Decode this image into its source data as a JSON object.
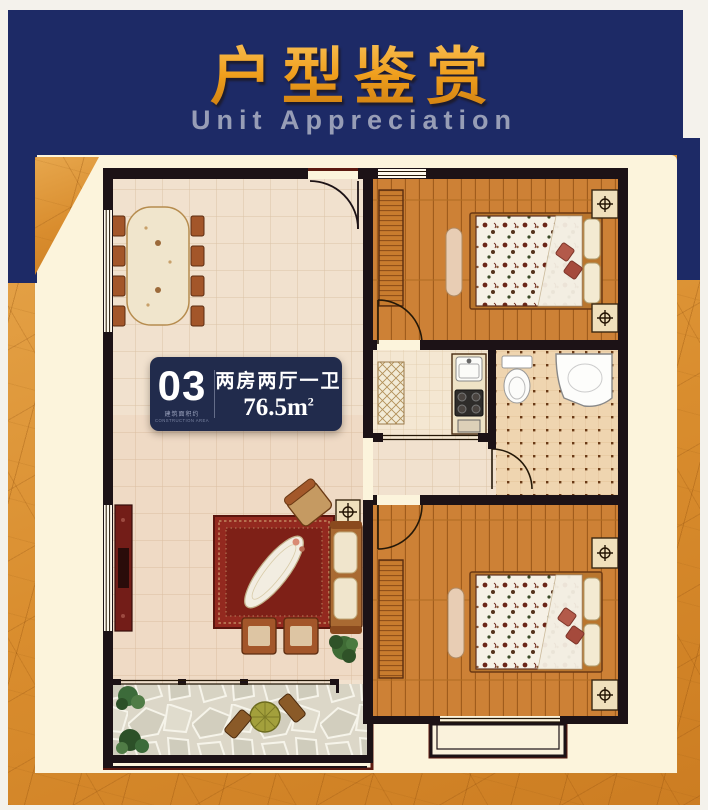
{
  "header": {
    "title": "户型鉴赏",
    "subtitle": "Unit Appreciation"
  },
  "badge": {
    "unit_number": "03",
    "construction_label_cn": "建筑面积约",
    "construction_label_en": "CONSTRUCTION AREA",
    "layout_type": "两房两厅一卫",
    "area_value": "76.5m",
    "area_sup": "2"
  },
  "colors": {
    "navy": "#1d2a66",
    "orange": "#dd9434",
    "gold": "#ef9e1c",
    "cream": "#fcf4dc",
    "badge-navy": "#212b4c",
    "subtitle-gray": "#979db6"
  }
}
